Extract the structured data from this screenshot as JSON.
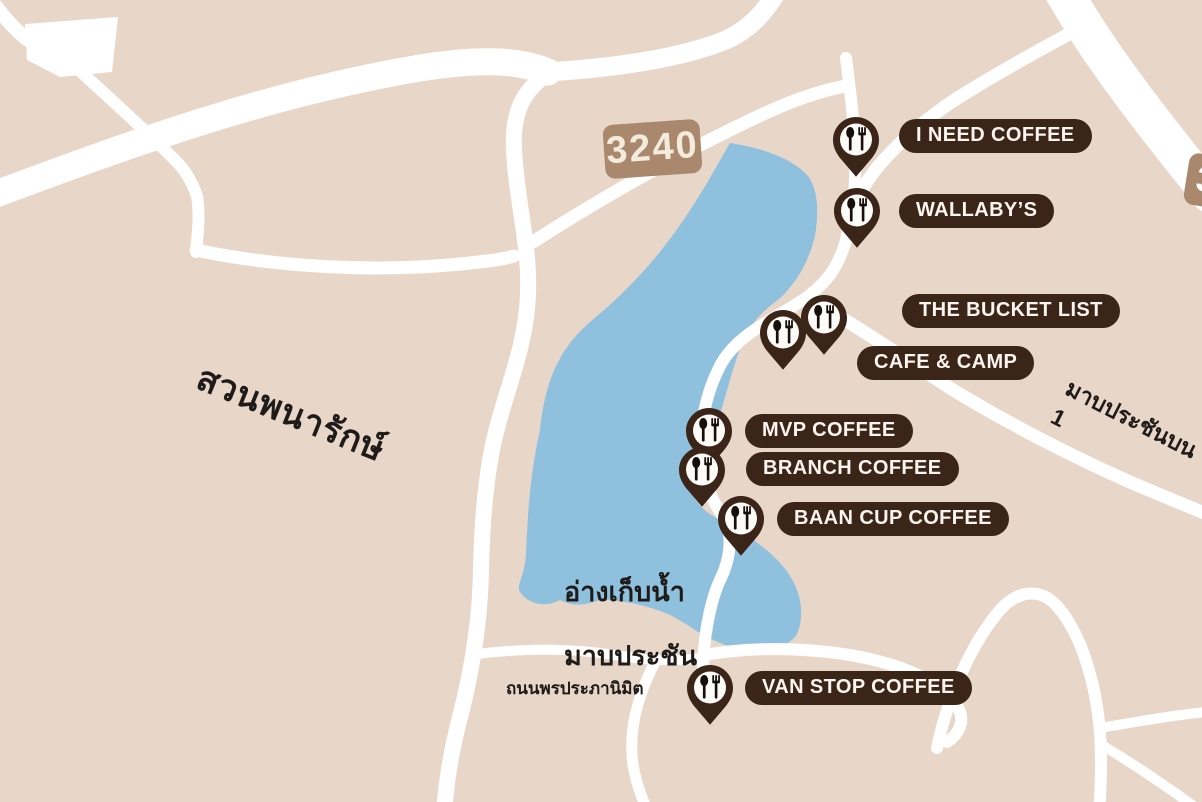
{
  "map": {
    "colors": {
      "land": "#e8d6c9",
      "lake": "#8fc1de",
      "road": "#ffffff",
      "pin_brown": "#3b2418",
      "label_text": "#faf5ee",
      "route_marker_bg": "#a9886e"
    },
    "route_markers": [
      {
        "id": "3240",
        "text": "3240"
      },
      {
        "id": "partial-right-edge",
        "text": "3"
      }
    ],
    "area_labels": [
      {
        "id": "park",
        "text": "สวนพนารักษ์"
      },
      {
        "id": "reservoir",
        "line1": "อ่างเก็บน้ำ",
        "line2": "มาบประชัน"
      },
      {
        "id": "road-south",
        "text": "ถนนพรประภานิมิต"
      },
      {
        "id": "road-east",
        "text": "มาบประชันบน 1"
      }
    ],
    "places": [
      {
        "id": "i-need-coffee",
        "label": "I NEED COFFEE",
        "pin": {
          "x": 856,
          "y": 140
        },
        "tag": {
          "x": 899,
          "y": 119
        }
      },
      {
        "id": "wallabys",
        "label": "WALLABY’S",
        "pin": {
          "x": 857,
          "y": 211
        },
        "tag": {
          "x": 899,
          "y": 194
        }
      },
      {
        "id": "the-bucket-list",
        "label": "THE BUCKET LIST",
        "pin": {
          "x": 824,
          "y": 318
        },
        "tag": {
          "x": 902,
          "y": 294
        }
      },
      {
        "id": "cafe-and-camp",
        "label": "CAFE & CAMP",
        "pin": {
          "x": 783,
          "y": 333
        },
        "tag": {
          "x": 857,
          "y": 346
        }
      },
      {
        "id": "mvp-coffee",
        "label": "MVP COFFEE",
        "pin": {
          "x": 709,
          "y": 431
        },
        "tag": {
          "x": 745,
          "y": 414
        }
      },
      {
        "id": "branch-coffee",
        "label": "BRANCH COFFEE",
        "pin": {
          "x": 702,
          "y": 470
        },
        "tag": {
          "x": 746,
          "y": 452
        }
      },
      {
        "id": "baan-cup-coffee",
        "label": "BAAN CUP COFFEE",
        "pin": {
          "x": 741,
          "y": 519
        },
        "tag": {
          "x": 777,
          "y": 502
        }
      },
      {
        "id": "van-stop-coffee",
        "label": "VAN STOP COFFEE",
        "pin": {
          "x": 710,
          "y": 688
        },
        "tag": {
          "x": 745,
          "y": 671
        }
      }
    ]
  }
}
